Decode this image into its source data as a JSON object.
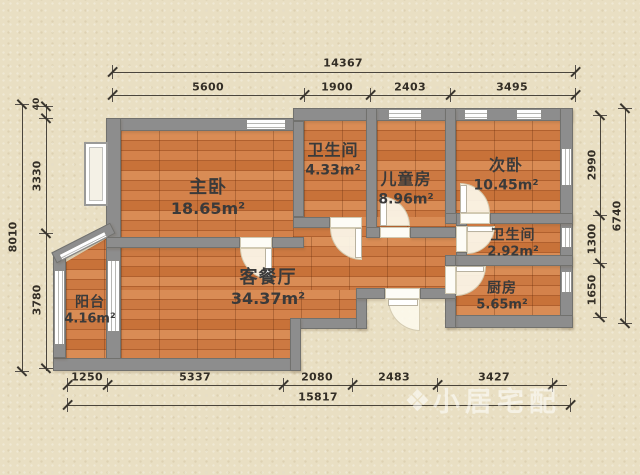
{
  "palette": {
    "background": "#e9dfc3",
    "wall": "#8d8d8d",
    "floor": "#ce7b45",
    "dimension_text": "#332e26",
    "label_text": "#3a3a3a",
    "watermark_color": "rgba(255,255,255,0.55)"
  },
  "rooms": [
    {
      "name": "主卧",
      "area": "18.65m²"
    },
    {
      "name": "卫生间",
      "area": "4.33m²"
    },
    {
      "name": "儿童房",
      "area": "8.96m²"
    },
    {
      "name": "次卧",
      "area": "10.45m²"
    },
    {
      "name": "卫生间",
      "area": "2.92m²"
    },
    {
      "name": "厨房",
      "area": "5.65m²"
    },
    {
      "name": "客餐厅",
      "area": "34.37m²"
    },
    {
      "name": "阳台",
      "area": "4.16m²"
    }
  ],
  "dimensions": {
    "top_total": "14367",
    "top_segments": [
      "5600",
      "1900",
      "2403",
      "3495"
    ],
    "bottom_total": "15817",
    "bottom_segments": [
      "1250",
      "5337",
      "2080",
      "2483",
      "3427"
    ],
    "left_total": "8010",
    "left_segments": [
      "40",
      "3330",
      "3780"
    ],
    "right_total": "6740",
    "right_segments": [
      "2990",
      "1300",
      "1650"
    ]
  },
  "watermark": {
    "logo": "❖",
    "text": "小居宅配"
  }
}
